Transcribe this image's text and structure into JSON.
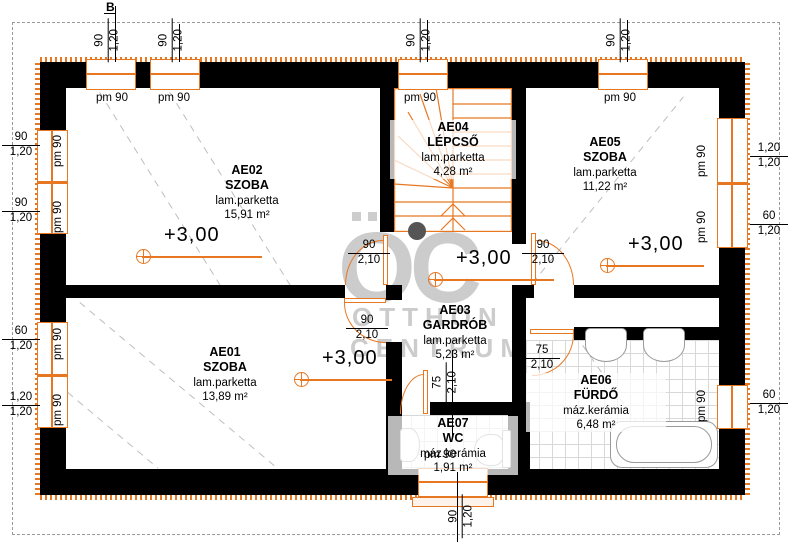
{
  "section_mark": "B",
  "watermark": {
    "logo": "OC",
    "line1": "OTTHON",
    "line2": "CENTRUM"
  },
  "rooms": [
    {
      "id": "AE01",
      "name": "SZOBA",
      "floor": "lam.parketta",
      "area": "13,89 m²"
    },
    {
      "id": "AE02",
      "name": "SZOBA",
      "floor": "lam.parketta",
      "area": "15,91 m²"
    },
    {
      "id": "AE03",
      "name": "GARDRÓB",
      "floor": "lam.parketta",
      "area": "5,23 m²"
    },
    {
      "id": "AE04",
      "name": "LÉPCSŐ",
      "floor": "lam.parketta",
      "area": "4,28 m²"
    },
    {
      "id": "AE05",
      "name": "SZOBA",
      "floor": "lam.parketta",
      "area": "11,22 m²"
    },
    {
      "id": "AE06",
      "name": "FÜRDŐ",
      "floor": "máz.kerámia",
      "area": "6,48 m²"
    },
    {
      "id": "AE07",
      "name": "WC",
      "floor": "máz.kerámia",
      "area": "1,91 m²"
    }
  ],
  "levels": {
    "mark": "+3,00"
  },
  "windows": {
    "top": [
      {
        "w": "90",
        "h": "1,20",
        "sill": "pm 90"
      },
      {
        "w": "90",
        "h": "1,20",
        "sill": "pm 90"
      },
      {
        "w": "90",
        "h": "1,20",
        "sill": "pm 90"
      },
      {
        "w": "90",
        "h": "1,20",
        "sill": "pm 90"
      }
    ],
    "left": [
      {
        "w": "90",
        "h": "1,20",
        "sill": "pm 90"
      },
      {
        "w": "90",
        "h": "1,20",
        "sill": "pm 90"
      },
      {
        "w": "60",
        "h": "1,20",
        "sill": "pm 90"
      },
      {
        "w": "1,20",
        "h": "1,20",
        "sill": "pm 90"
      }
    ],
    "right": [
      {
        "w": "1,20",
        "h": "1,20",
        "sill": "pm 90"
      },
      {
        "w": "60",
        "h": "1,20",
        "sill": "pm 90"
      },
      {
        "w": "60",
        "h": "1,20",
        "sill": "pm 90"
      }
    ],
    "bottom": [
      {
        "w": "90",
        "h": "1,20",
        "sill": "pm 90"
      }
    ]
  },
  "doors": {
    "ae02": {
      "w": "90",
      "h": "2,10"
    },
    "ae05": {
      "w": "90",
      "h": "2,10"
    },
    "ae01": {
      "w": "90",
      "h": "2,10"
    },
    "bath": {
      "w": "75",
      "h": "2,10"
    },
    "wc": {
      "w": "75",
      "h": "2,10"
    }
  },
  "colors": {
    "accent": "#e87722",
    "wall": "#000000",
    "watermark": "#9b9b9b",
    "tile_line": "#d8d8d8"
  }
}
